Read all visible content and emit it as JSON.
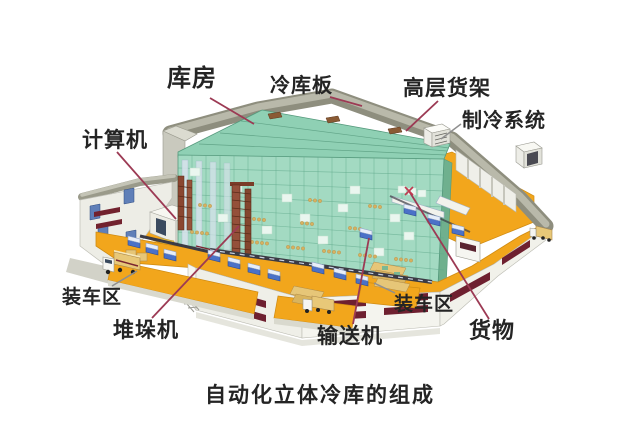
{
  "title": {
    "text": "自动化立体冷库的组成"
  },
  "labels": {
    "kufang": {
      "text": "库房"
    },
    "lengkuban": {
      "text": "冷库板"
    },
    "gaocenghuojia": {
      "text": "高层货架"
    },
    "zhilengxitong": {
      "text": "制冷系统"
    },
    "jisuanji": {
      "text": "计算机"
    },
    "zhuangchequ_left": {
      "text": "装车区"
    },
    "duiduoji": {
      "text": "堆垛机"
    },
    "shusongji": {
      "text": "输送机"
    },
    "zhuangchequ_right": {
      "text": "装车区"
    },
    "huowu": {
      "text": "货物"
    }
  },
  "colors": {
    "background": "#FFFFFF",
    "label_text": "#242424",
    "leader_line_red": "#9C3A54",
    "leader_line_gray": "#8F8F8F",
    "floor_orange": "#F2A61C",
    "rack_green": "#A3DAC2",
    "roof_gray": "#9A9A8A",
    "wall_white": "#EFEFE8",
    "vent_slot_maroon": "#6E2030",
    "conveyor_blue": "#4A71C8",
    "crane_brown": "#8A4630",
    "truck_tan": "#E8C878"
  }
}
